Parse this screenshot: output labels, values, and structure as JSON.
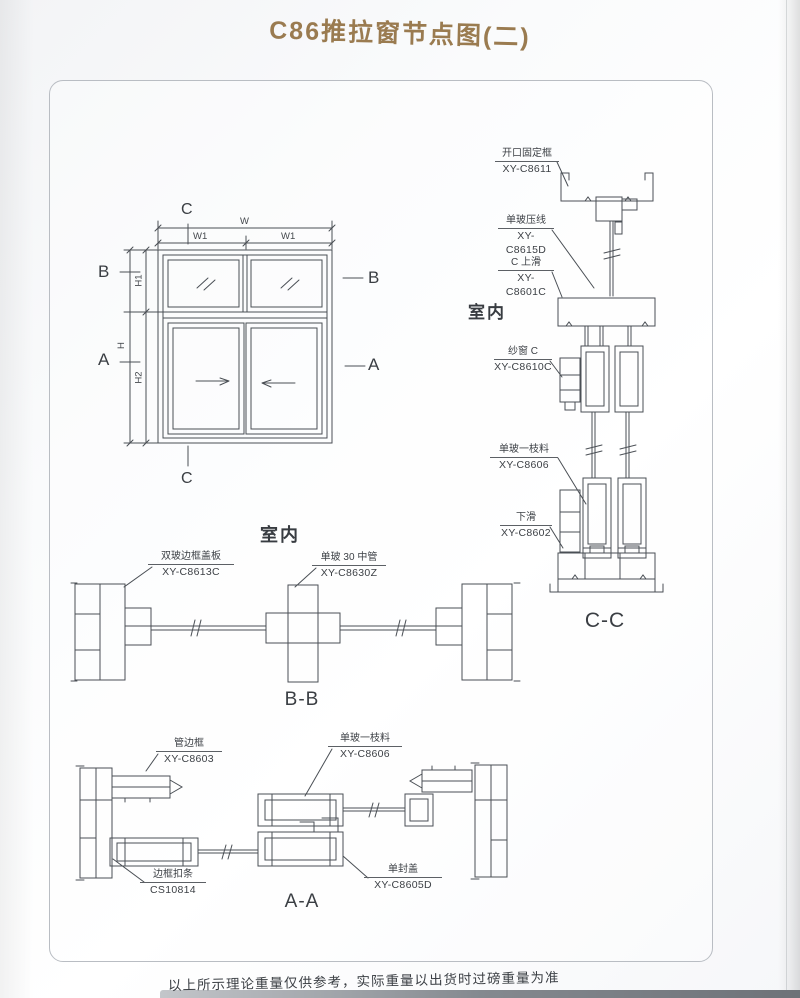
{
  "page": {
    "title": "C86推拉窗节点图(二)",
    "footer_note": "以上所示理论重量仅供参考，实际重量以出货时过磅重量为准",
    "accent_color": "#9a7b50",
    "line_color": "#4a4f55"
  },
  "elevation": {
    "marker_c_top": "C",
    "marker_c_bottom": "C",
    "marker_b_left": "B",
    "marker_b_right": "B",
    "marker_a_left": "A",
    "marker_a_right": "A",
    "dims": {
      "w": "W",
      "w1_left": "W1",
      "w1_right": "W1",
      "h": "H",
      "h1": "H1",
      "h2": "H2"
    }
  },
  "section_cc": {
    "room_label": "室内",
    "caption": "C-C",
    "callouts": {
      "fixed_frame": {
        "name": "开口固定框",
        "code": "XY-C8611"
      },
      "glass_bead": {
        "name": "单玻压线",
        "code": "XY-C8615D"
      },
      "top_slide": {
        "name": "C 上滑",
        "code": "XY-C8601C"
      },
      "screen": {
        "name": "纱窗 C",
        "code": "XY-C8610C"
      },
      "sash_profile": {
        "name": "单玻一枝料",
        "code": "XY-C8606"
      },
      "bottom_slide": {
        "name": "下滑",
        "code": "XY-C8602"
      }
    }
  },
  "section_bb": {
    "room_label": "室内",
    "caption": "B-B",
    "callouts": {
      "cover_plate": {
        "name": "双玻边框盖板",
        "code": "XY-C8613C"
      },
      "mid_tube": {
        "name": "单玻 30 中管",
        "code": "XY-C8630Z"
      }
    }
  },
  "section_aa": {
    "caption": "A-A",
    "callouts": {
      "tube_frame": {
        "name": "管边框",
        "code": "XY-C8603"
      },
      "sash_profile": {
        "name": "单玻一枝料",
        "code": "XY-C8606"
      },
      "frame_clip": {
        "name": "边框扣条",
        "code": "CS10814"
      },
      "end_cap": {
        "name": "单封盖",
        "code": "XY-C8605D"
      }
    }
  }
}
